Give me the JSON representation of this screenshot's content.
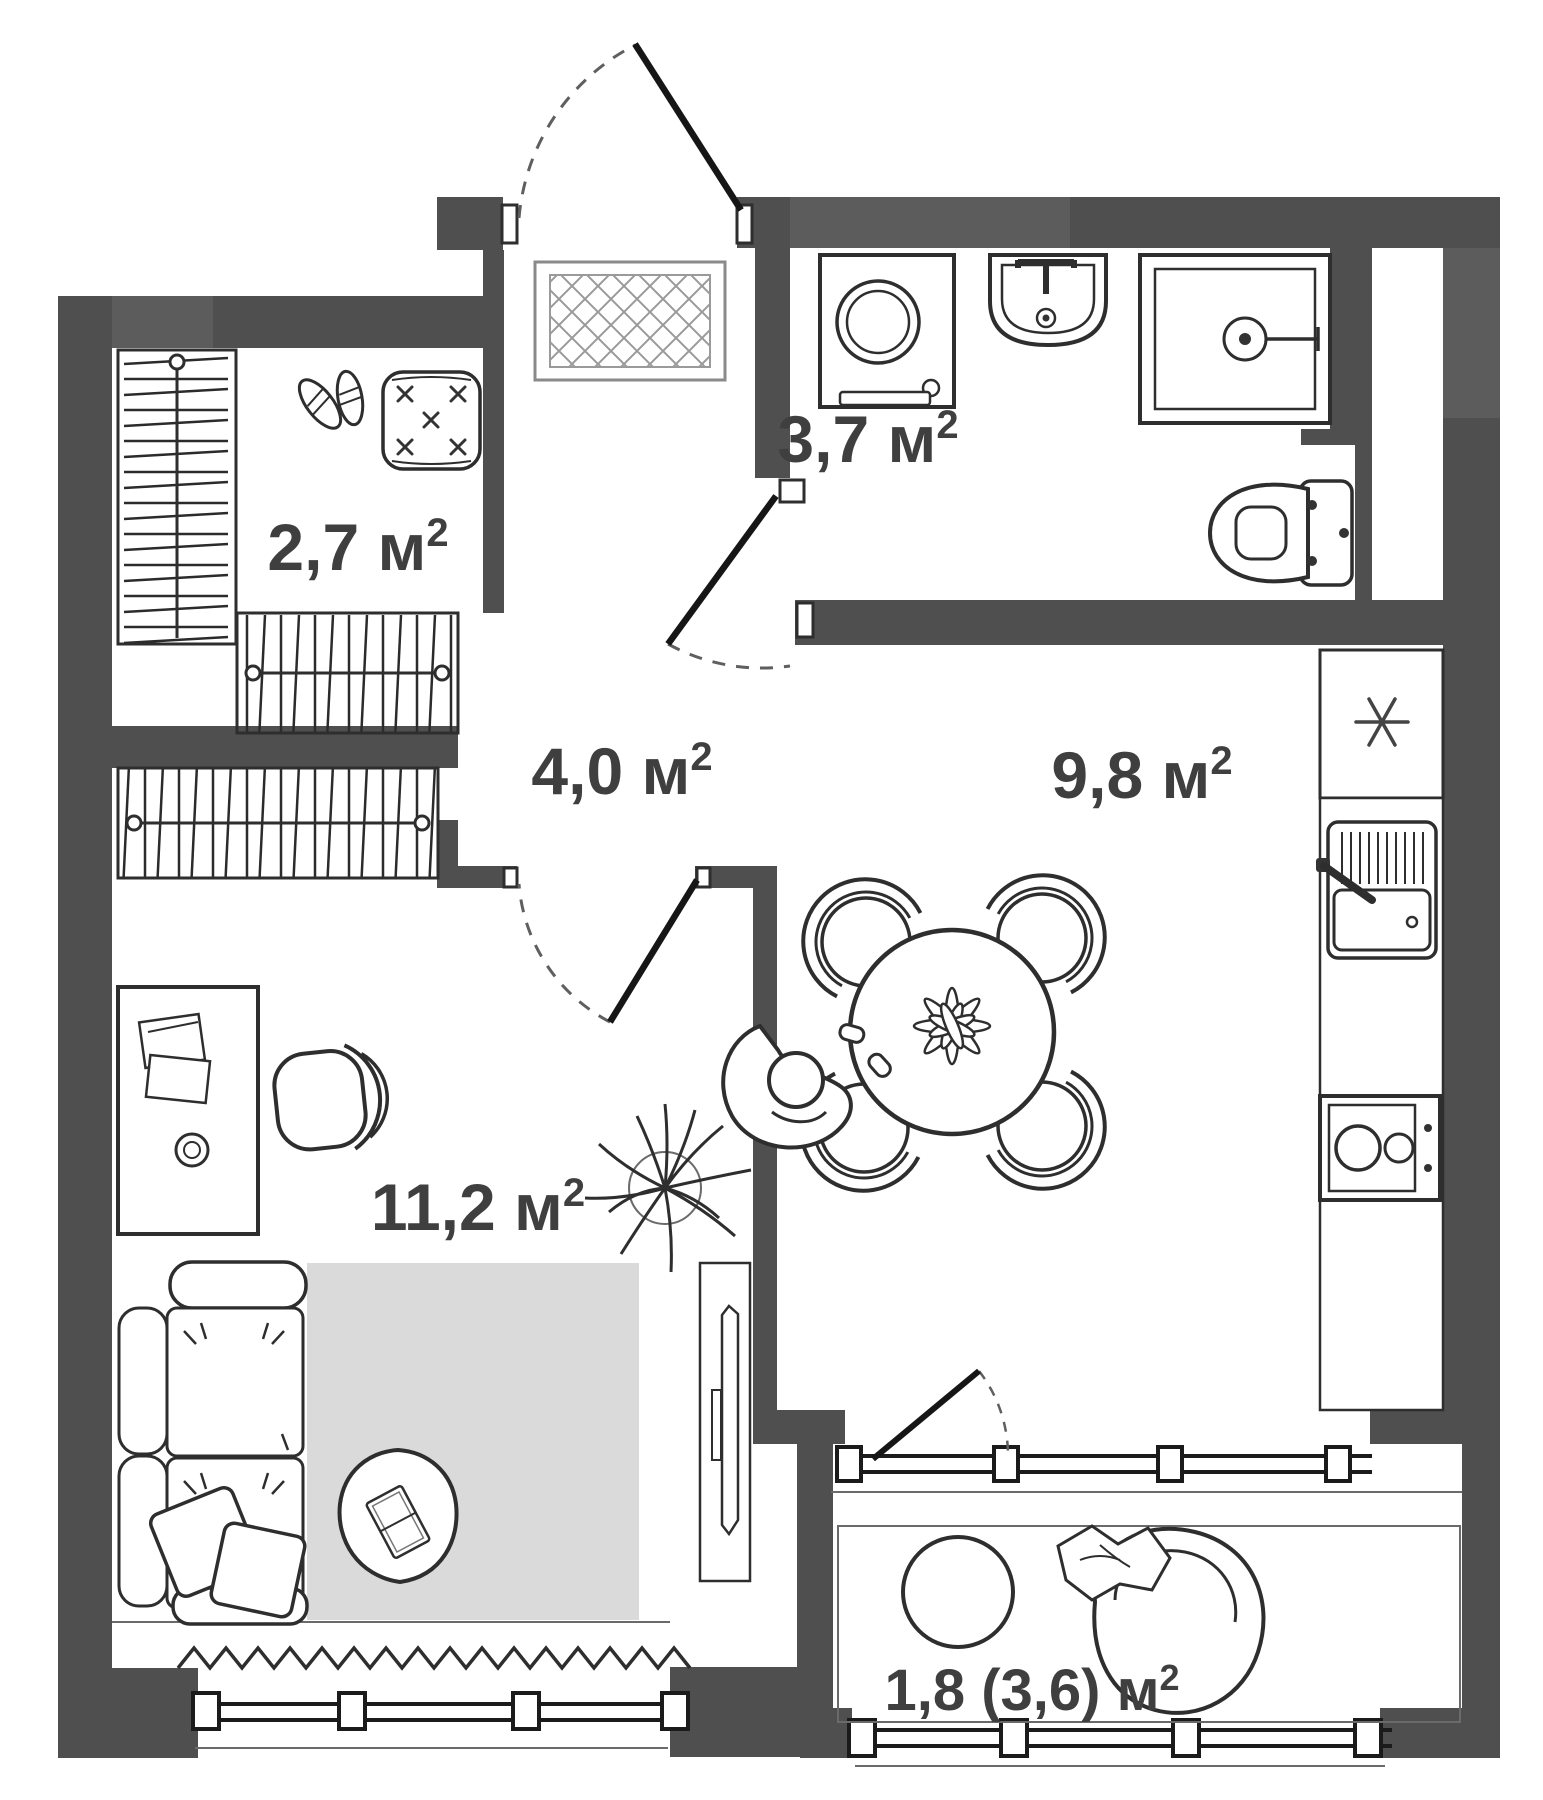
{
  "plan": {
    "title": "Studio apartment floor plan",
    "unit_base": " м",
    "unit_sup": "2",
    "rooms": [
      {
        "id": "entry",
        "name": "entry-closet",
        "area": "2,7",
        "area_value": 2.7
      },
      {
        "id": "bathroom",
        "name": "bathroom",
        "area": "3,7",
        "area_value": 3.7
      },
      {
        "id": "hallway",
        "name": "hallway",
        "area": "4,0",
        "area_value": 4.0
      },
      {
        "id": "kitchen",
        "name": "kitchen",
        "area": "9,8",
        "area_value": 9.8
      },
      {
        "id": "living_room",
        "name": "living-room",
        "area": "11,2",
        "area_value": 11.2
      },
      {
        "id": "balcony",
        "name": "balcony",
        "area": "1,8 (3,6)",
        "area_value": 1.8,
        "area_value_full": 3.6
      }
    ],
    "icons": {
      "refrigerator_marker": "snowflake-asterisk",
      "furniture": [
        "coat-rack",
        "shoe-pair",
        "pouf",
        "doormat",
        "entrance-door",
        "wardrobe",
        "wardrobe",
        "washing-machine",
        "washbasin",
        "shower-cabin",
        "toilet",
        "refrigerator",
        "kitchen-sink",
        "cooktop",
        "dining-table",
        "dining-chair",
        "seated-person",
        "desk",
        "office-chair",
        "house-plant",
        "tv-console",
        "sofa",
        "cushions",
        "area-rug",
        "coffee-table",
        "curtain",
        "window",
        "balcony-door",
        "balcony-table",
        "lounge-chair"
      ]
    },
    "colors": {
      "wall": "#4f4f4f",
      "wall_light": "#5c5c5c",
      "line": "#2e2e2e",
      "rug": "#dadada",
      "label": "#3f3f3f",
      "background": "#ffffff"
    }
  }
}
